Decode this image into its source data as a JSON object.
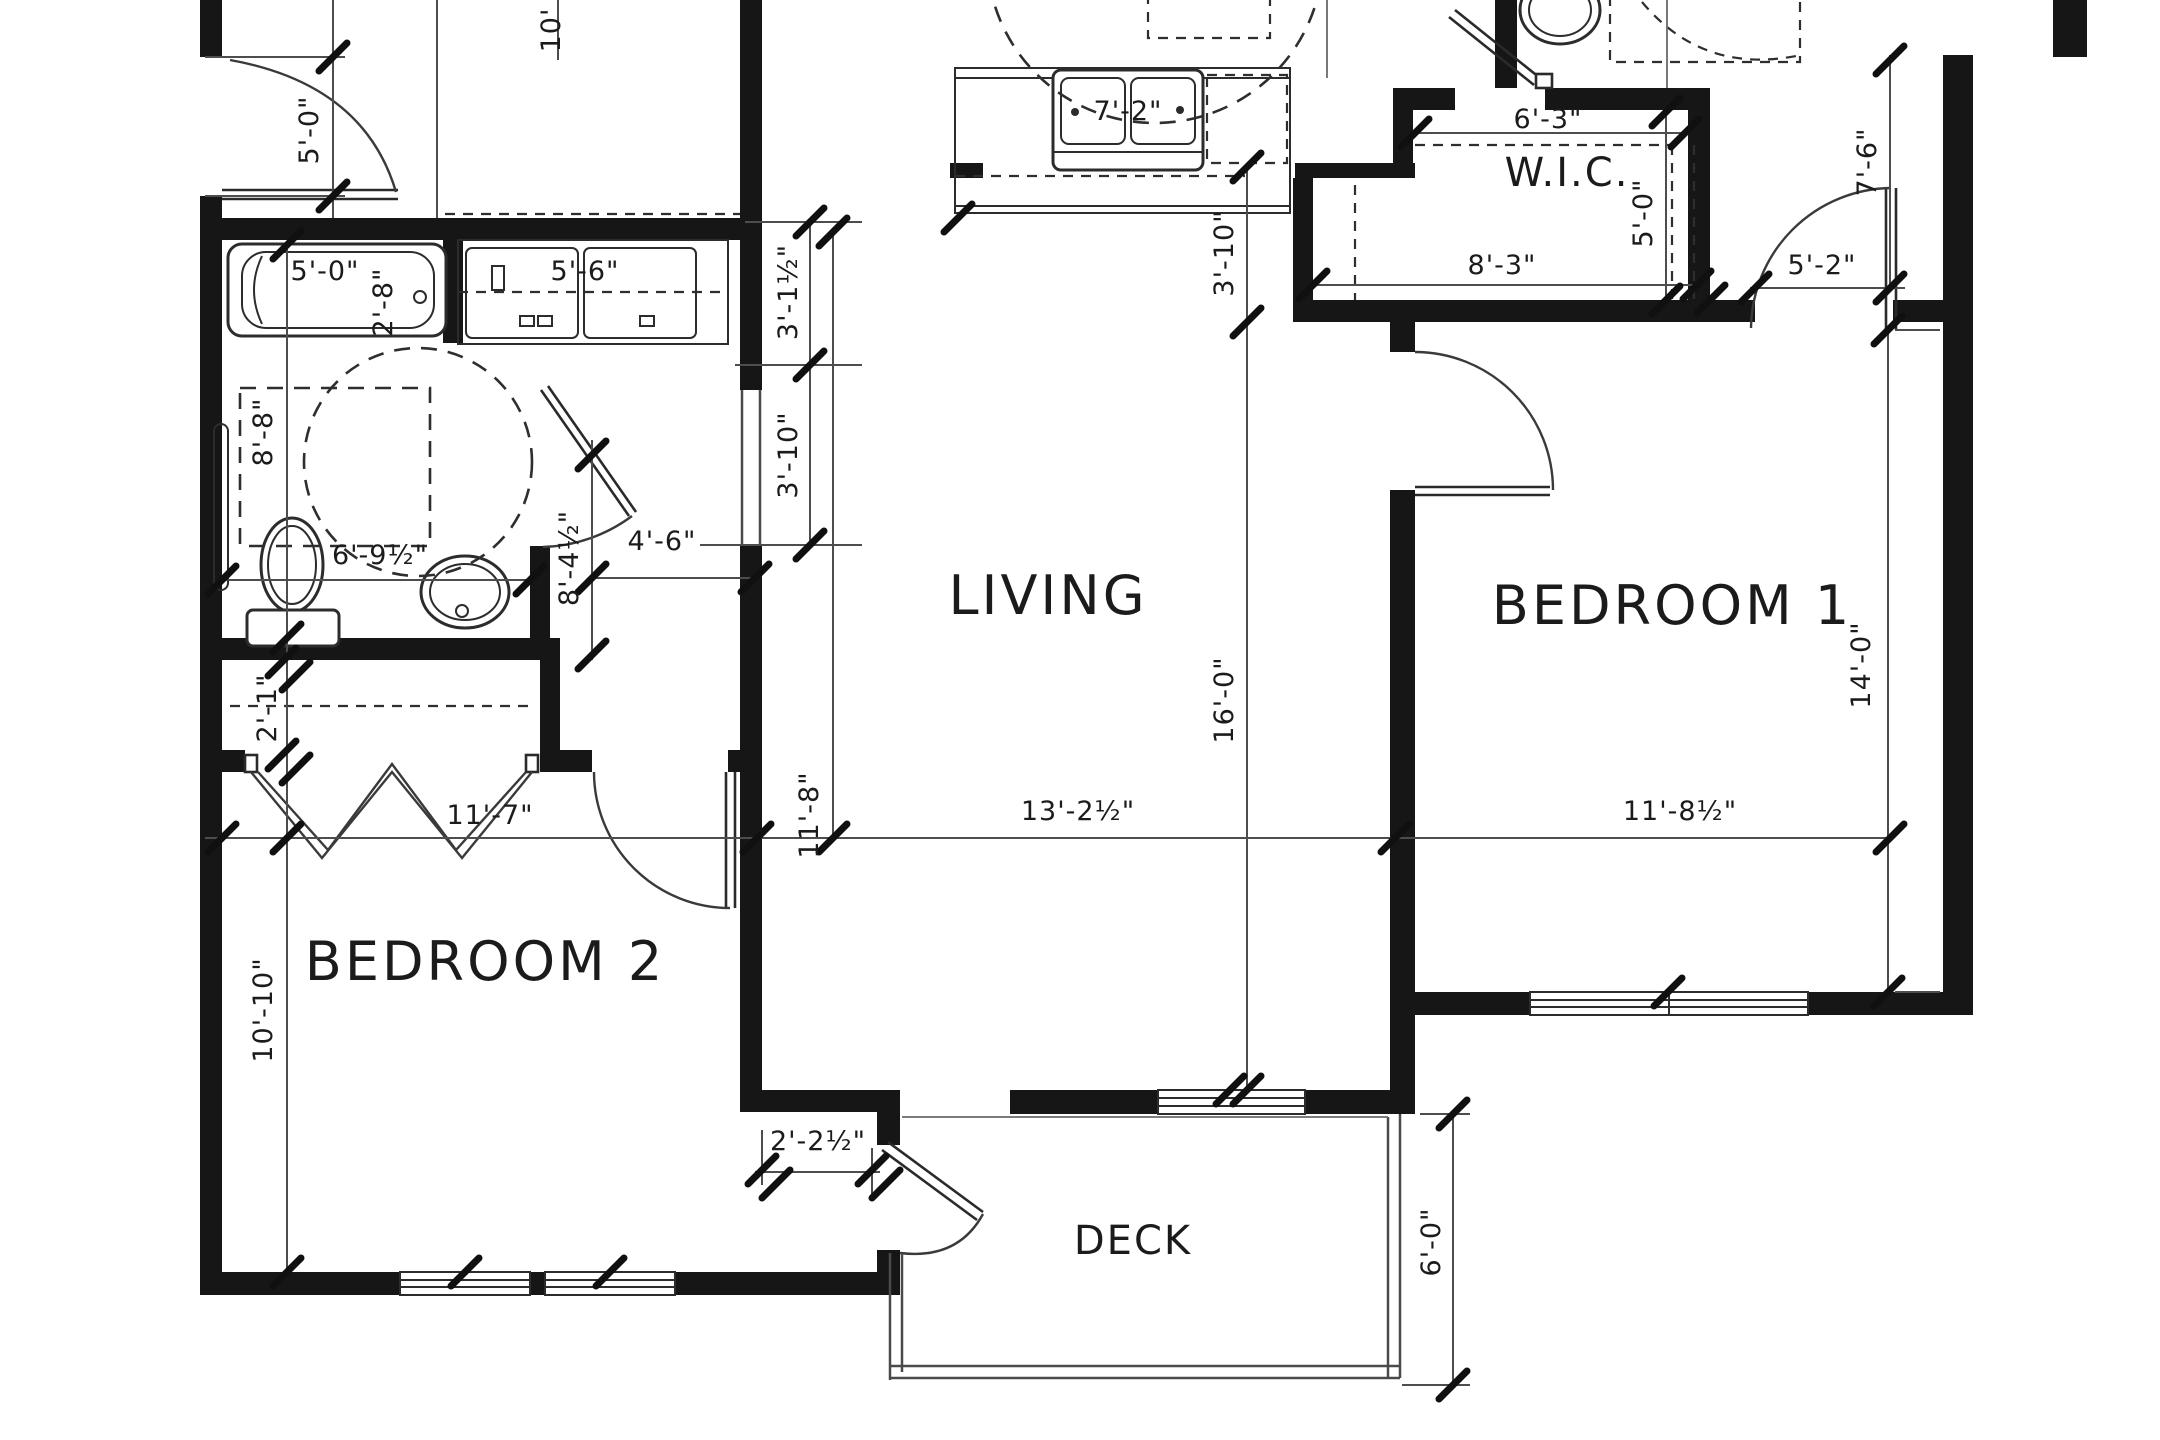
{
  "drawing": {
    "background": "#ffffff",
    "wall_color": "#161616",
    "dim_color": "#4d4d4d"
  },
  "rooms": {
    "living": "LIVING",
    "bedroom1": "BEDROOM 1",
    "bedroom2": "BEDROOM 2",
    "wic": "W.I.C.",
    "deck": "DECK"
  },
  "dims": {
    "entry_door": "5'-0\"",
    "top_partial": "10'",
    "tub_length": "5'-0\"",
    "tub_width": "2'-8\"",
    "laundry_width": "5'-6\"",
    "bath_length": "8'-8\"",
    "bath_width": "6'-9½\"",
    "bath_wall": "8'-4½\"",
    "hall_width": "4'-6\"",
    "seg_3_1": "3'-1½\"",
    "seg_3_10": "3'-10\"",
    "closet_depth": "2'-1\"",
    "bedroom2_width": "11'-7\"",
    "hall_height": "11'-8\"",
    "living_width": "13'-2½\"",
    "living_height": "16'-0\"",
    "kitchen_sink": "7'-2\"",
    "kitchen_side": "3'-10\"",
    "wic_width": "6'-3\"",
    "wic_depth": "5'-0\"",
    "wic_lower": "8'-3\"",
    "bed1_door": "5'-2\"",
    "hall_right": "7'-6\"",
    "bedroom1_height": "14'-0\"",
    "bedroom1_width": "11'-8½\"",
    "bedroom2_height": "10'-10\"",
    "step": "2'-2½\"",
    "deck_depth": "6'-0\""
  },
  "icons": {
    "bathtub": "bathtub-icon",
    "toilet": "toilet-icon",
    "sink": "sink-icon",
    "kitchen_sink": "kitchen-sink-icon",
    "dishwasher": "dishwasher-icon",
    "washer_dryer": "washer-dryer-icon",
    "door_swing": "door-swing-icon",
    "turning_circle": "turning-radius-icon"
  }
}
